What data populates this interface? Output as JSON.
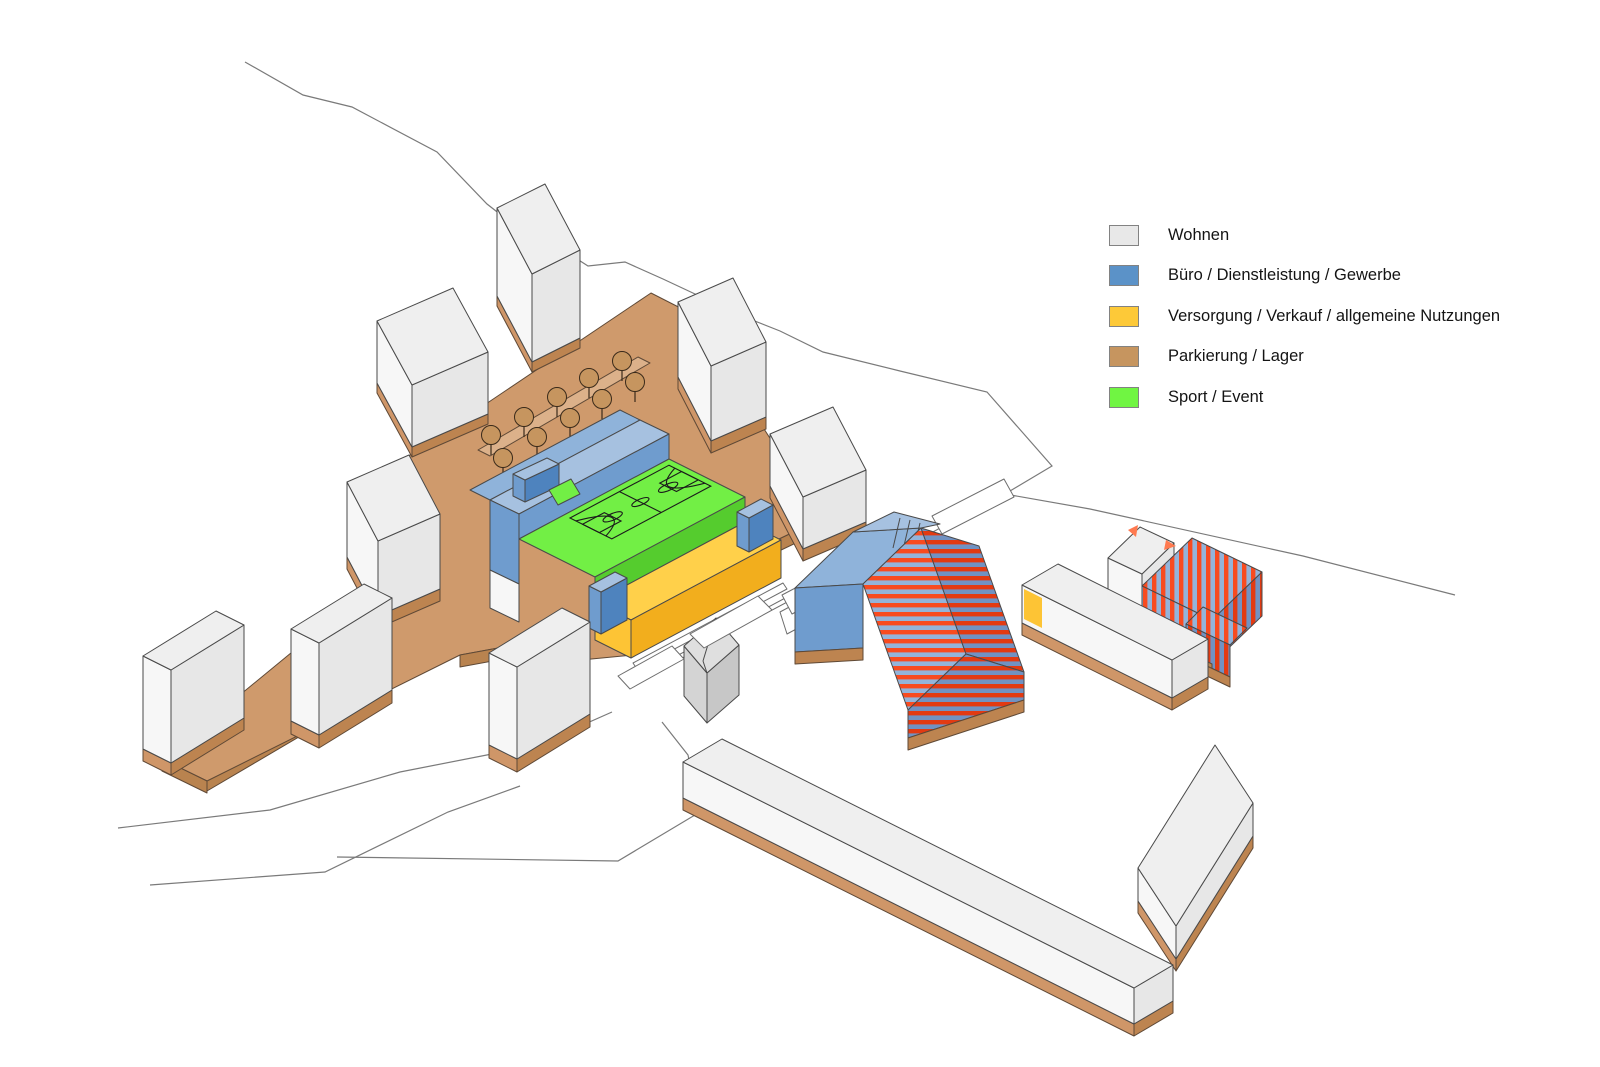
{
  "canvas": {
    "background": "#ffffff"
  },
  "legend": {
    "items": [
      {
        "label": "Wohnen",
        "color": "#e8e8e8"
      },
      {
        "label": "Büro / Dienstleistung / Gewerbe",
        "color": "#5b92c8"
      },
      {
        "label": "Versorgung / Verkauf / allgemeine Nutzungen",
        "color": "#fdc938"
      },
      {
        "label": "Parkierung / Lager",
        "color": "#c6955f"
      },
      {
        "label": "Sport / Event",
        "color": "#70f542"
      }
    ]
  },
  "palette": {
    "bg": "#ffffff",
    "outline": "#4a4a4a",
    "contour": "#7a7a7a",
    "brown_line": "#5f4936",
    "white_top": "#efefef",
    "white_left": "#f7f7f7",
    "white_right": "#e7e7e7",
    "base_left": "#cf9668",
    "base_right": "#bd8450",
    "deck_top": "#cf9a6c",
    "deck_side": "#b9834f",
    "deck_walk": "#dcb18a",
    "tree": "#c6955f",
    "blue_top": "#a6c1e0",
    "blue_light": "#8fb3da",
    "blue_mid": "#6f9cce",
    "blue_dark": "#4e83be",
    "green": "#72ef45",
    "green_dark": "#55cc2e",
    "yellow_top": "#ffd04a",
    "yellow_mid": "#fdc435",
    "yellow_dark": "#f2ae1d",
    "gray_roof": "#dfdfdf",
    "gray_wall": "#d4d4d4",
    "gray_wall2": "#c7c7c7",
    "stripe_bg": "#94b4da",
    "stripe_red": "#f84b20",
    "stripe_bg_dark": "#7192c2",
    "stripe_red_dark": "#e23a12",
    "accent_triangle": "#ff7a50"
  }
}
